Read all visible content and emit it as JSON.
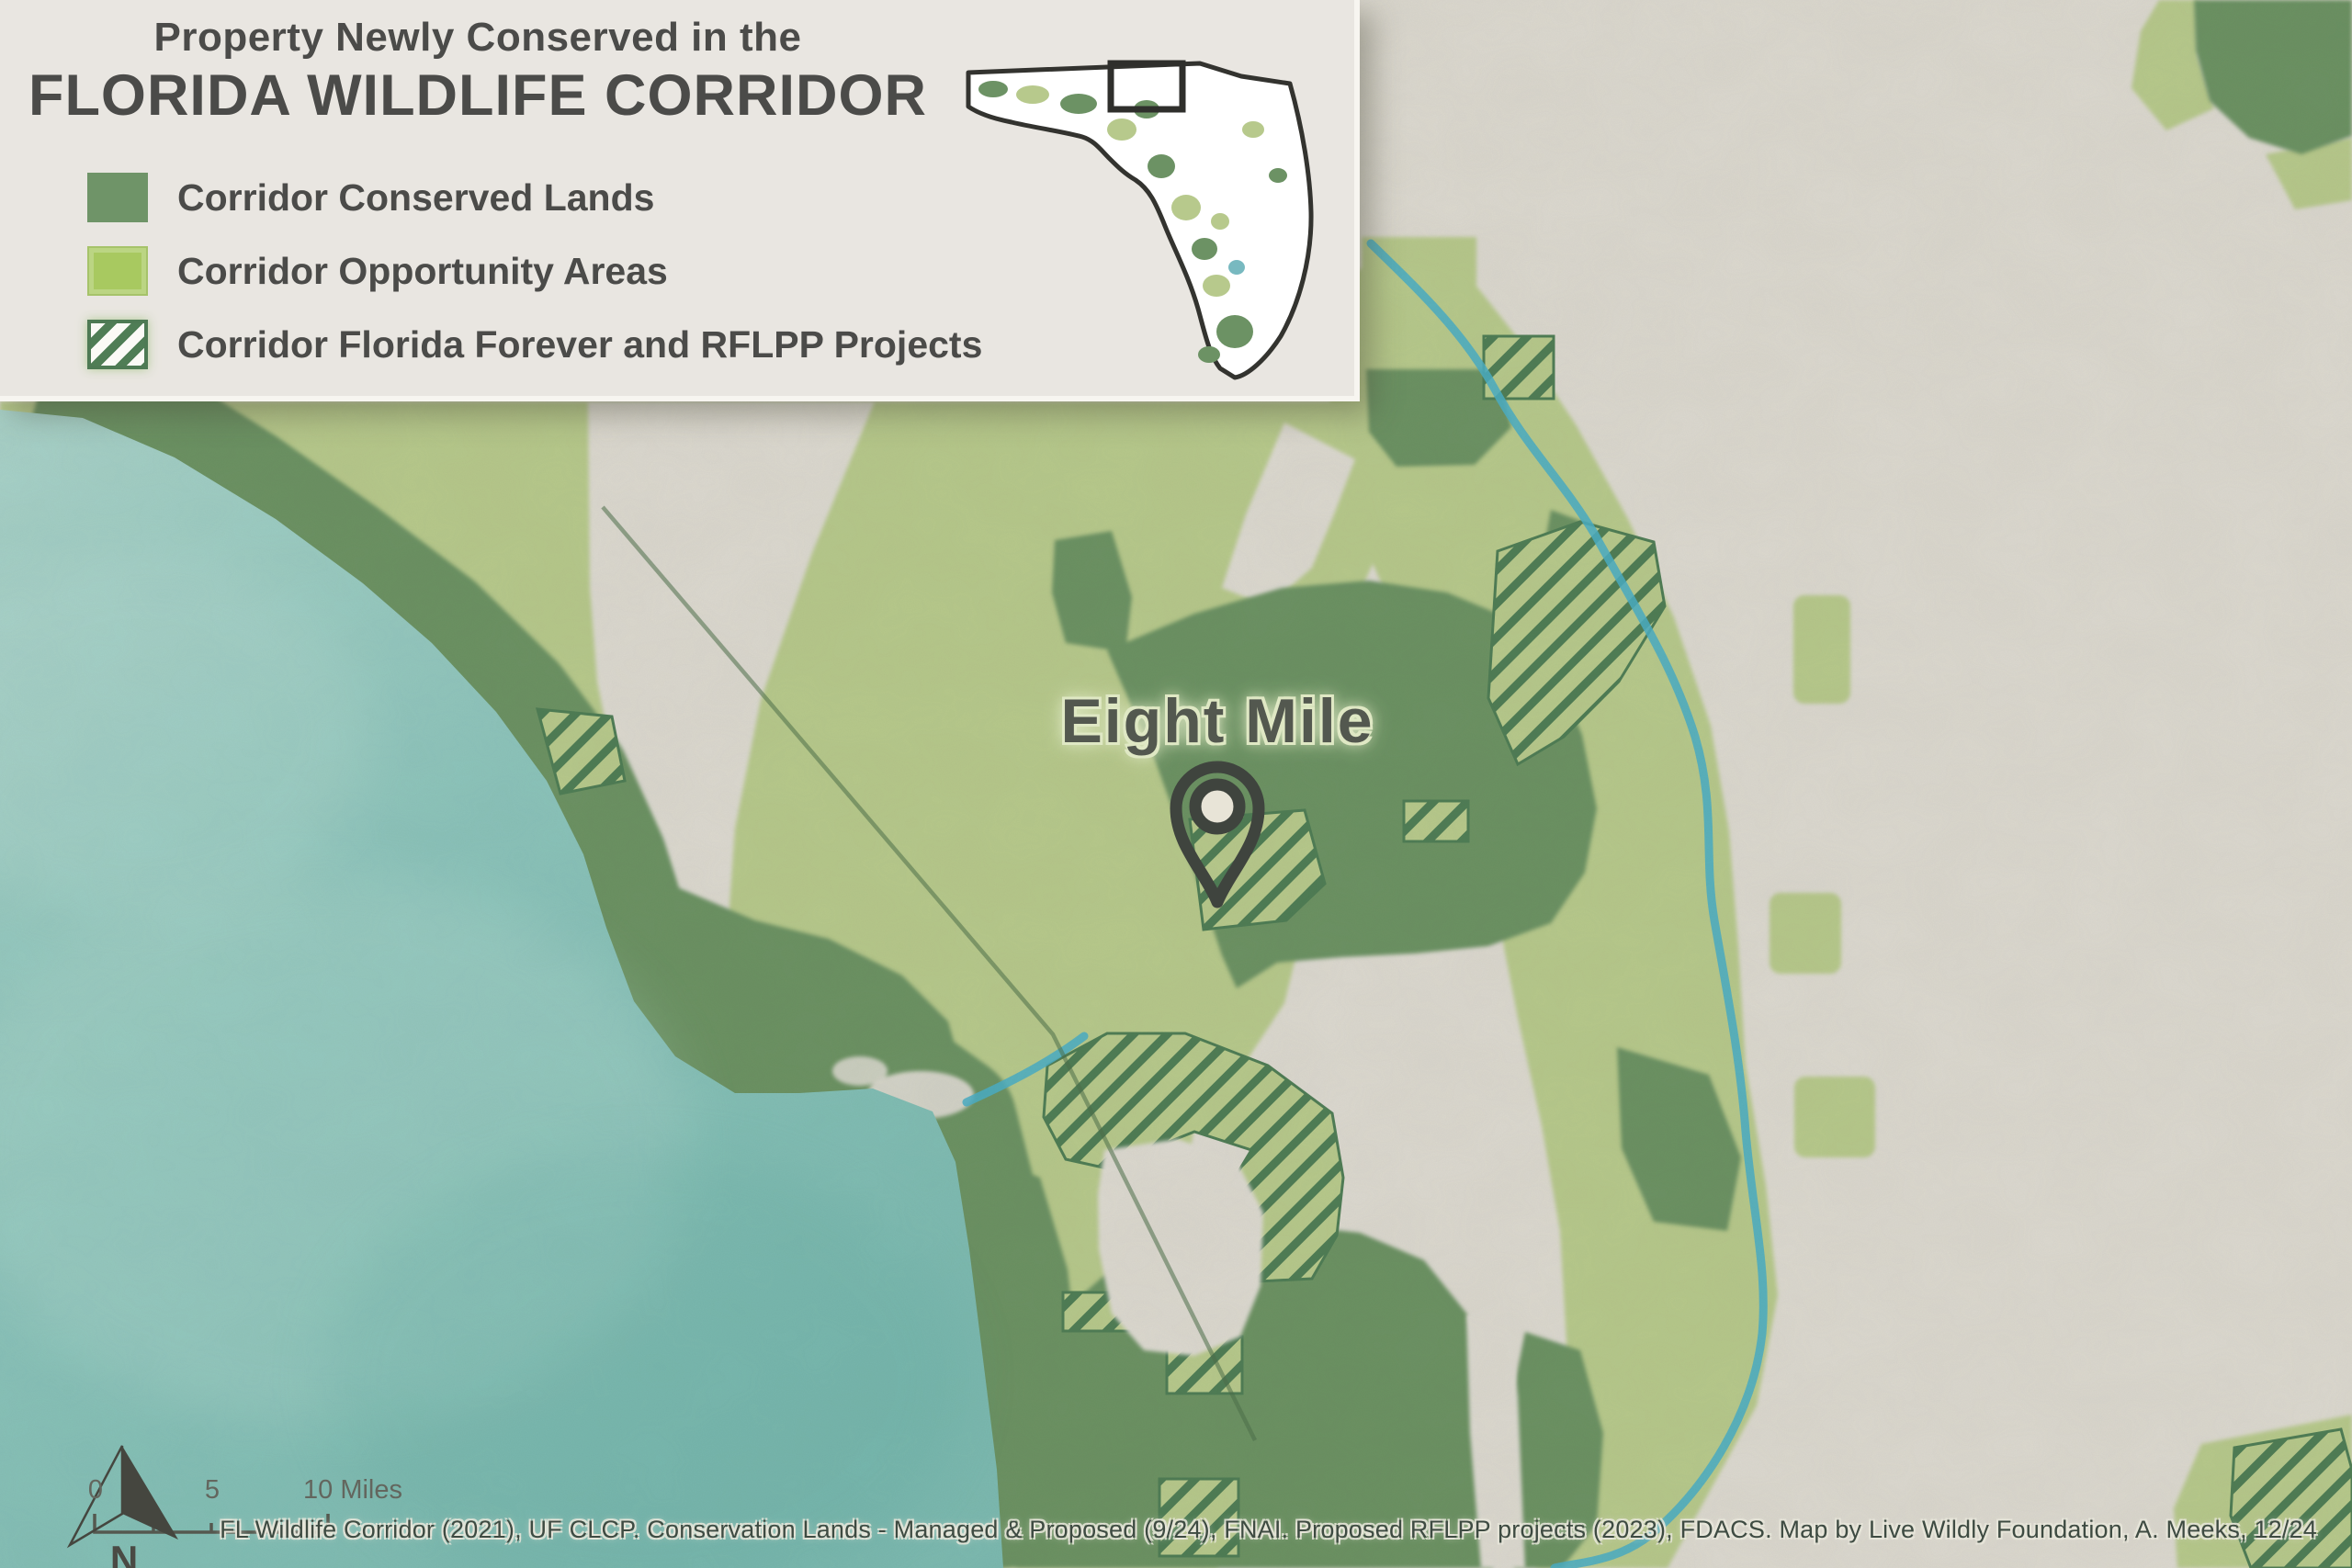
{
  "title": {
    "line1": "Property Newly Conserved in the",
    "line2": "FLORIDA WILDLIFE CORRIDOR"
  },
  "legend": {
    "items": [
      {
        "label": "Corridor Conserved Lands",
        "color": "#6f9468"
      },
      {
        "label": "Corridor Opportunity Areas",
        "color": "#a8c960"
      },
      {
        "label": "Corridor Florida Forever and RFLPP Projects",
        "fill": "#fbfaf6",
        "stripe": "#517f58"
      }
    ]
  },
  "map": {
    "place_label": "Eight Mile"
  },
  "scale_bar": {
    "labels": [
      "0",
      "5",
      "10 Miles"
    ]
  },
  "north_arrow": {
    "label": "N"
  },
  "attribution": "FL Wildlife Corridor (2021), UF CLCP. Conservation Lands - Managed & Proposed (9/24), FNAI. Proposed RFLPP projects (2023), FDACS. Map by Live Wildly Foundation, A. Meeks, 12/24",
  "palette": {
    "paper": "#dcd9d0",
    "panel": "#e9e6e1",
    "water-light": "#a9d2c9",
    "water": "#8cc4bb",
    "water-deep": "#7cbab1",
    "conserved": "#6c9264",
    "opportunity": "#b7c98c",
    "hatchline": "#4f7d55",
    "river": "#4aaec6",
    "ink": "#4b4b49",
    "halo": "#dfe8c4",
    "pin": "#3f443e",
    "pin-fill": "#e8e4d7",
    "attr": "#3e4b42",
    "swatch-conserved": "#6f9468",
    "swatch-opportunity": "#a8c960"
  }
}
